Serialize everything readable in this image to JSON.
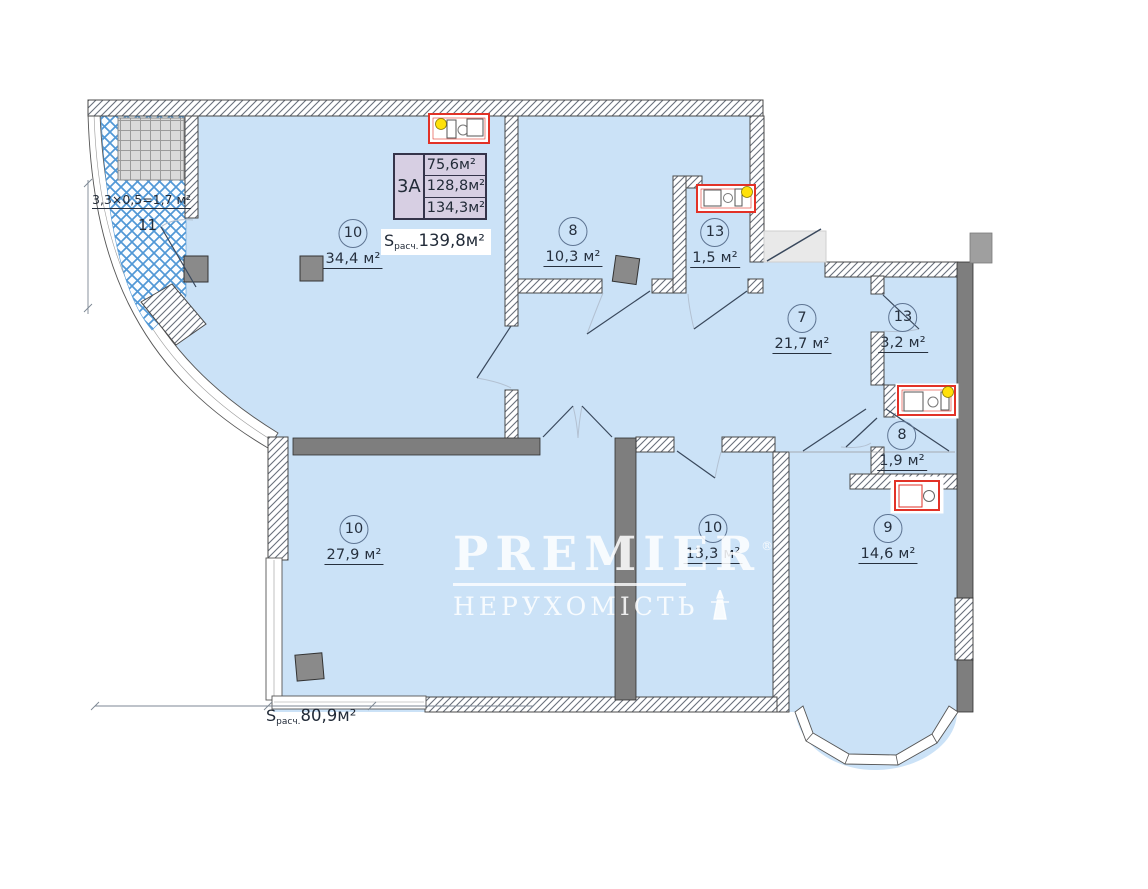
{
  "plan": {
    "legend": {
      "type_label": "3А",
      "area_rows": [
        "75,6м²",
        "128,8м²",
        "134,3м²"
      ]
    },
    "s_calc_top": {
      "s": "S",
      "sub": "расч.",
      "value": "139,8м²"
    },
    "s_calc_bottom": {
      "s": "S",
      "sub": "расч.",
      "value": "80,9м²"
    },
    "balcony": {
      "number": "11",
      "dimension": "3,3×0,5=1,7 м²"
    },
    "rooms": [
      {
        "number": "10",
        "area": "34,4 м²"
      },
      {
        "number": "8",
        "area": "10,3 м²"
      },
      {
        "number": "13",
        "area": "1,5 м²"
      },
      {
        "number": "7",
        "area": "21,7 м²"
      },
      {
        "number": "13",
        "area": "3,2 м²"
      },
      {
        "number": "8",
        "area": "1,9 м²"
      },
      {
        "number": "9",
        "area": "14,6 м²"
      },
      {
        "number": "10",
        "area": "27,9 м²"
      },
      {
        "number": "10",
        "area": "13,3 м²"
      }
    ],
    "watermark": {
      "brand": "PREMIER",
      "reg": "®",
      "subtitle": "НЕРУХОМІСТЬ"
    },
    "colors": {
      "floor": "#cbe2f7",
      "wall_gray": "#7e7e7e",
      "fixture_red": "#e23227",
      "marker_yellow": "#ffe10a",
      "legend_bg": "#d7cfe3",
      "balcony_hatch_blue": "#5198d6"
    }
  }
}
